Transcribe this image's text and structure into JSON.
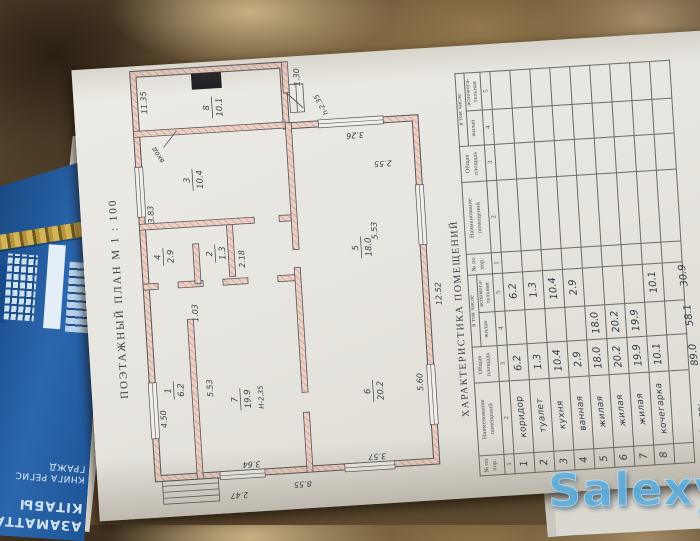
{
  "watermark": "Salexy",
  "book": {
    "title_kk_line1": "АЗАМАТТАРДЫ",
    "title_kk_line2": "КІТАБЫ",
    "title_ru_line1": "КНИГА РЕГИС",
    "title_ru_line2": "ГРАЖД"
  },
  "plan": {
    "title": "ПОЭТАЖНЫЙ ПЛАН  М 1 : 100",
    "rooms": [
      {
        "num": "1",
        "area": "6.2"
      },
      {
        "num": "2",
        "area": "1.3"
      },
      {
        "num": "3",
        "area": "10.4"
      },
      {
        "num": "4",
        "area": "2.9"
      },
      {
        "num": "5",
        "area": "18.0"
      },
      {
        "num": "6",
        "area": "20.2"
      },
      {
        "num": "7",
        "area": "19.9"
      },
      {
        "num": "8",
        "area": "10.1"
      }
    ],
    "dims": [
      "12.52",
      "8.55",
      "11.35",
      "5.53",
      "5.60",
      "3.64",
      "3.57",
      "3.26",
      "3.83",
      "4.50",
      "1.30",
      "2.47",
      "1.03",
      "2.18",
      "2.55",
      "5.53"
    ],
    "notes": {
      "height1": "Н-2.35",
      "height2": "h-2.35",
      "entrance": "вход"
    }
  },
  "table": {
    "title": "ХАРАКТЕРИСТИКА ПОМЕЩЕНИЙ",
    "headers": {
      "col1": "№ по пор.",
      "col2": "Наименование помещений",
      "col3": "Общая площадь",
      "group": "в том числе",
      "col4": "жилая",
      "col5": "вспомога- тельная"
    },
    "col_numbers": [
      "1",
      "2",
      "3",
      "4",
      "5"
    ],
    "rows": [
      {
        "n": "1",
        "name": "коридор",
        "total": "6.2",
        "living": "",
        "aux": "6.2"
      },
      {
        "n": "2",
        "name": "туалет",
        "total": "1.3",
        "living": "",
        "aux": "1.3"
      },
      {
        "n": "3",
        "name": "кухня",
        "total": "10.4",
        "living": "",
        "aux": "10.4"
      },
      {
        "n": "4",
        "name": "ванная",
        "total": "2.9",
        "living": "",
        "aux": "2.9"
      },
      {
        "n": "5",
        "name": "жилая",
        "total": "18.0",
        "living": "18.0",
        "aux": ""
      },
      {
        "n": "6",
        "name": "жилая",
        "total": "20.2",
        "living": "20.2",
        "aux": ""
      },
      {
        "n": "7",
        "name": "жилая",
        "total": "19.9",
        "living": "19.9",
        "aux": ""
      },
      {
        "n": "8",
        "name": "кочегарка",
        "total": "10.1",
        "living": "",
        "aux": "10.1"
      }
    ],
    "total": {
      "label": "Итого:",
      "total": "89.0",
      "living": "58.1",
      "aux": "30.9"
    }
  },
  "colors": {
    "wall_pink": "#e8c2b4",
    "book_blue": "#2b66ad",
    "watermark_blue": "#60b2e0",
    "paper": "#e7e5df"
  }
}
